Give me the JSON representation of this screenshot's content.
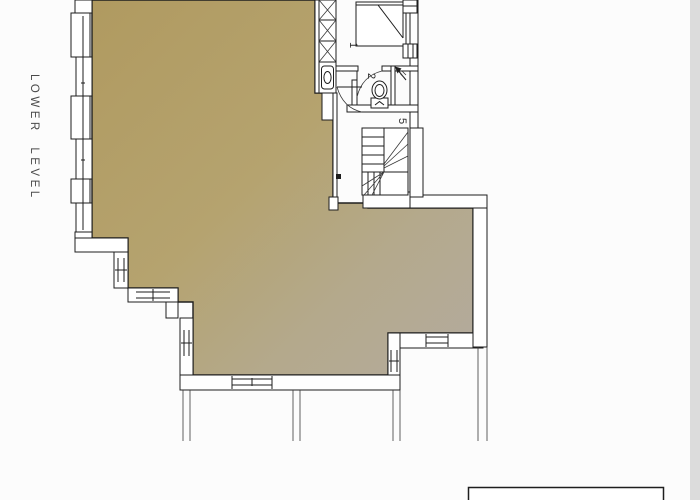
{
  "plan": {
    "title": "LOWER LEVEL",
    "room_labels": {
      "bedroom": "1",
      "wc": "2",
      "hall": "5"
    },
    "colors": {
      "floor_tan": "#b29c63",
      "floor_gray": "#b3ab9e",
      "wall_line": "#1e1e1e",
      "wall_fill": "#ffffff",
      "title_text": "#4a4a4a",
      "screen_edge_strip": "#dcdcdc"
    },
    "fixtures": [
      "bed",
      "closet",
      "washbasin",
      "toilet",
      "winder-stairs",
      "door-swing",
      "windows",
      "vent-arrow"
    ]
  }
}
